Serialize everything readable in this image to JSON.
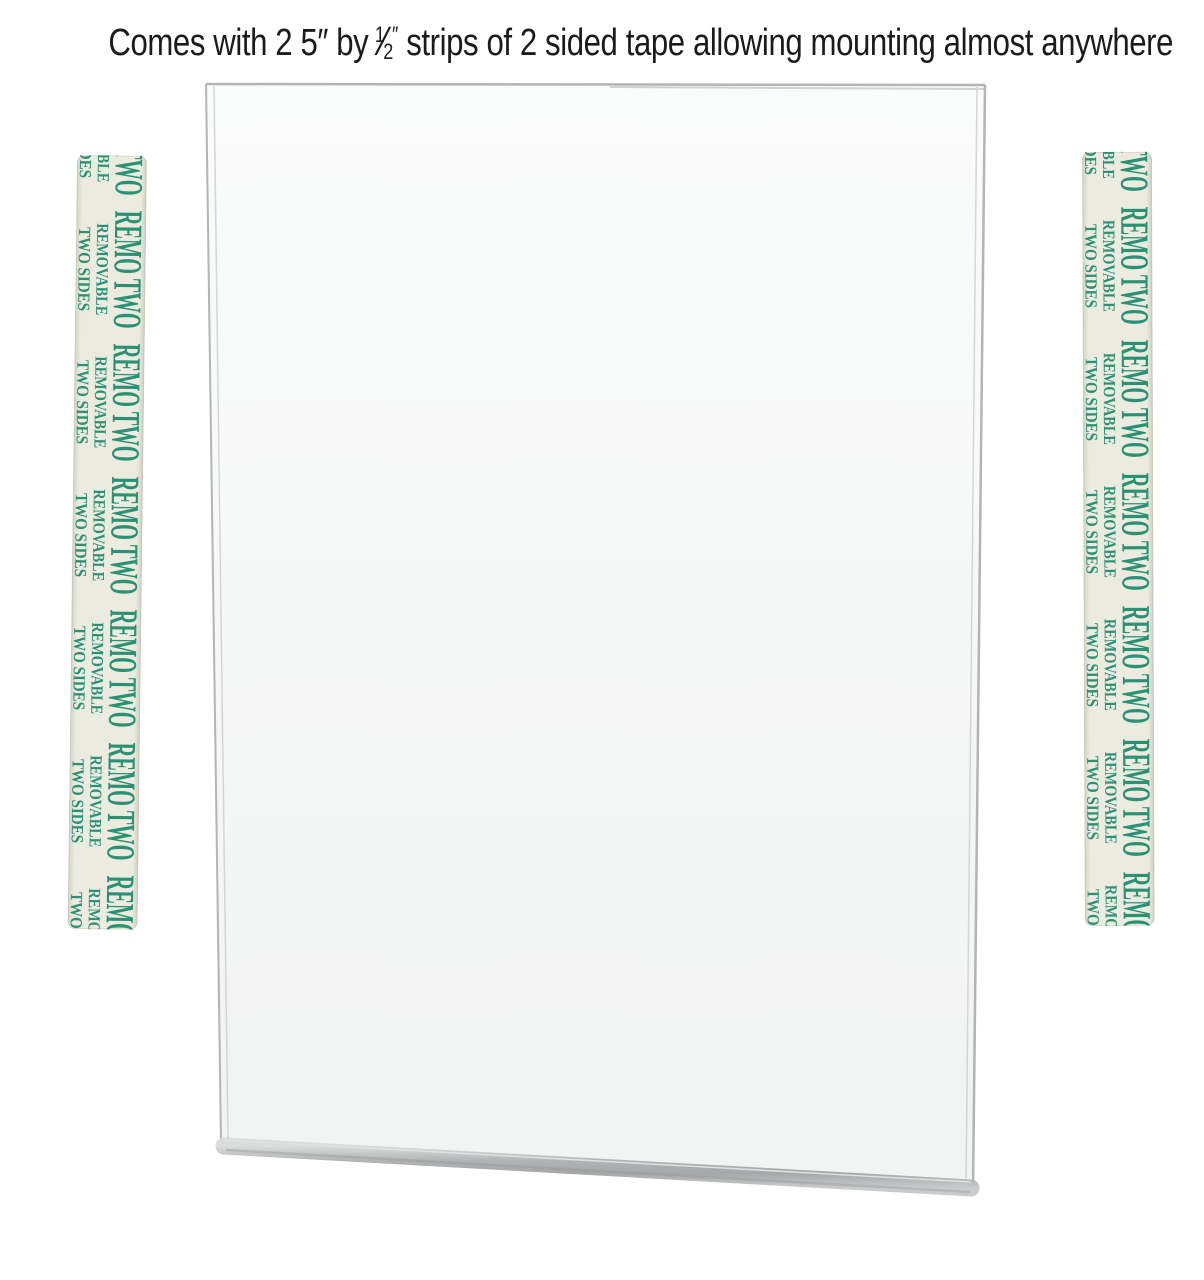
{
  "page": {
    "background_color": "#ffffff"
  },
  "headline": {
    "prefix": "Comes with 2 5″ by",
    "fraction_numerator": "1",
    "fraction_slash": "⁄",
    "fraction_denominator": "2",
    "fraction_unit": "″",
    "suffix": "strips of 2 sided tape allowing mounting almost anywhere",
    "text_color": "#1b1b1d"
  },
  "sign_holder": {
    "panel_color": "#f7f8f8",
    "edge_color": "#b2b4b5",
    "inner_edge_color": "#d4d5d6",
    "bottom_lip_color": "#aaacad"
  },
  "tape_strips": {
    "count": 2,
    "label_lines": [
      "REMO TWO",
      "REMOVABLE",
      "TWO SIDES"
    ],
    "label_repeats": 7,
    "text_color": "#2b9175",
    "tape_color": "#ecebdf",
    "tape_edge_color": "#d7d5c6"
  }
}
